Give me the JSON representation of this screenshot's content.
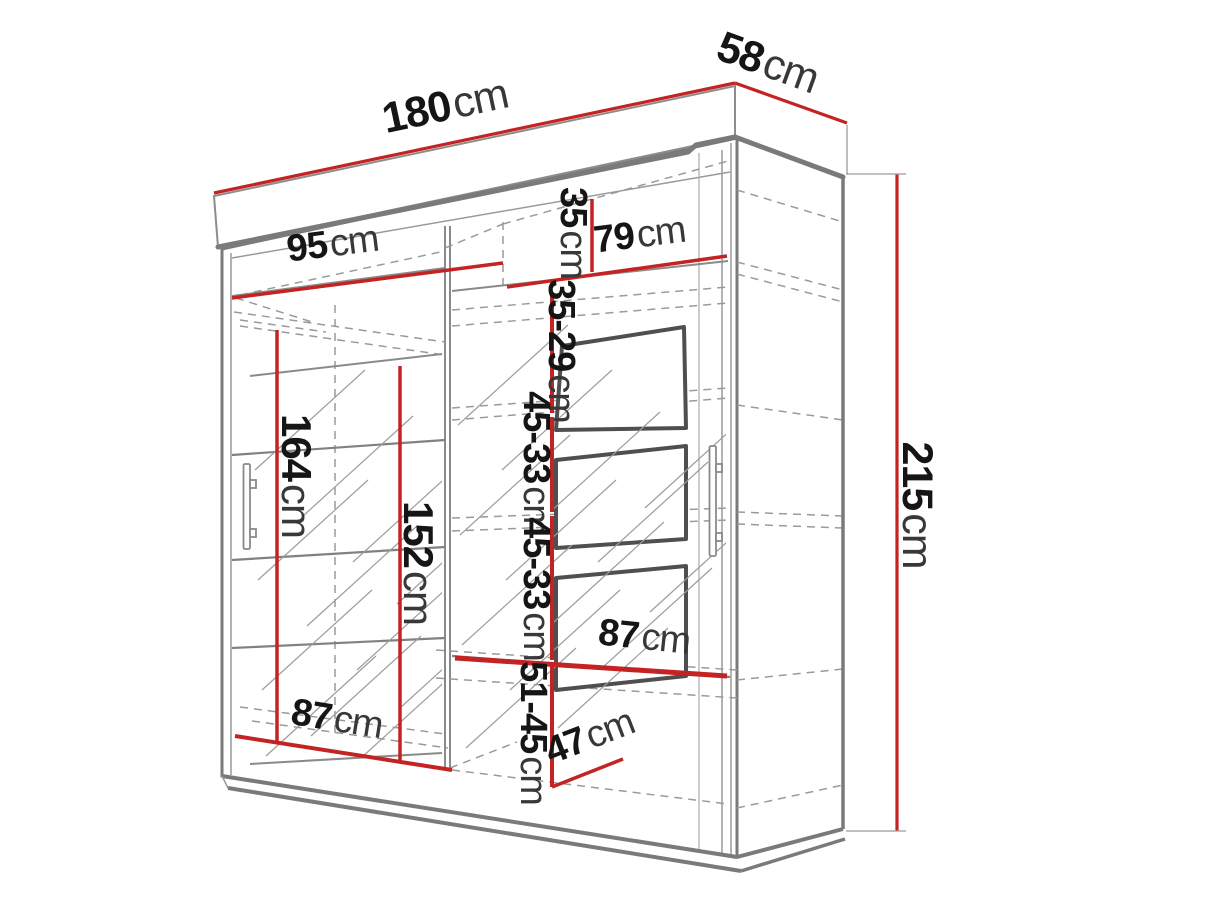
{
  "title": "wardrobe-dimension-diagram",
  "colors": {
    "red": "#c42323",
    "structure": "#7a7a7a",
    "dashed": "#9a9a9a",
    "panel": "#4f4f4f",
    "text": "#151515"
  },
  "dimensions": {
    "width": {
      "value": "180",
      "unit": "cm"
    },
    "depth": {
      "value": "58",
      "unit": "cm"
    },
    "height": {
      "value": "215",
      "unit": "cm"
    },
    "left_top_shelf_width": {
      "value": "95",
      "unit": "cm"
    },
    "right_top_shelf_width": {
      "value": "79",
      "unit": "cm"
    },
    "top_shelf_drop": {
      "value": "35",
      "unit": "cm"
    },
    "right_gap_upper": {
      "value": "35-29",
      "unit": "cm"
    },
    "right_gap_middle_1": {
      "value": "45-33",
      "unit": "cm"
    },
    "right_gap_middle_2": {
      "value": "45-33",
      "unit": "cm"
    },
    "left_interior_height": {
      "value": "164",
      "unit": "cm"
    },
    "left_hanging_height": {
      "value": "152",
      "unit": "cm"
    },
    "right_lower_shelf_width": {
      "value": "87",
      "unit": "cm"
    },
    "left_bottom_shelf_width": {
      "value": "87",
      "unit": "cm"
    },
    "right_gap_bottom": {
      "value": "51-45",
      "unit": "cm"
    },
    "usable_depth": {
      "value": "47",
      "unit": "cm"
    }
  }
}
